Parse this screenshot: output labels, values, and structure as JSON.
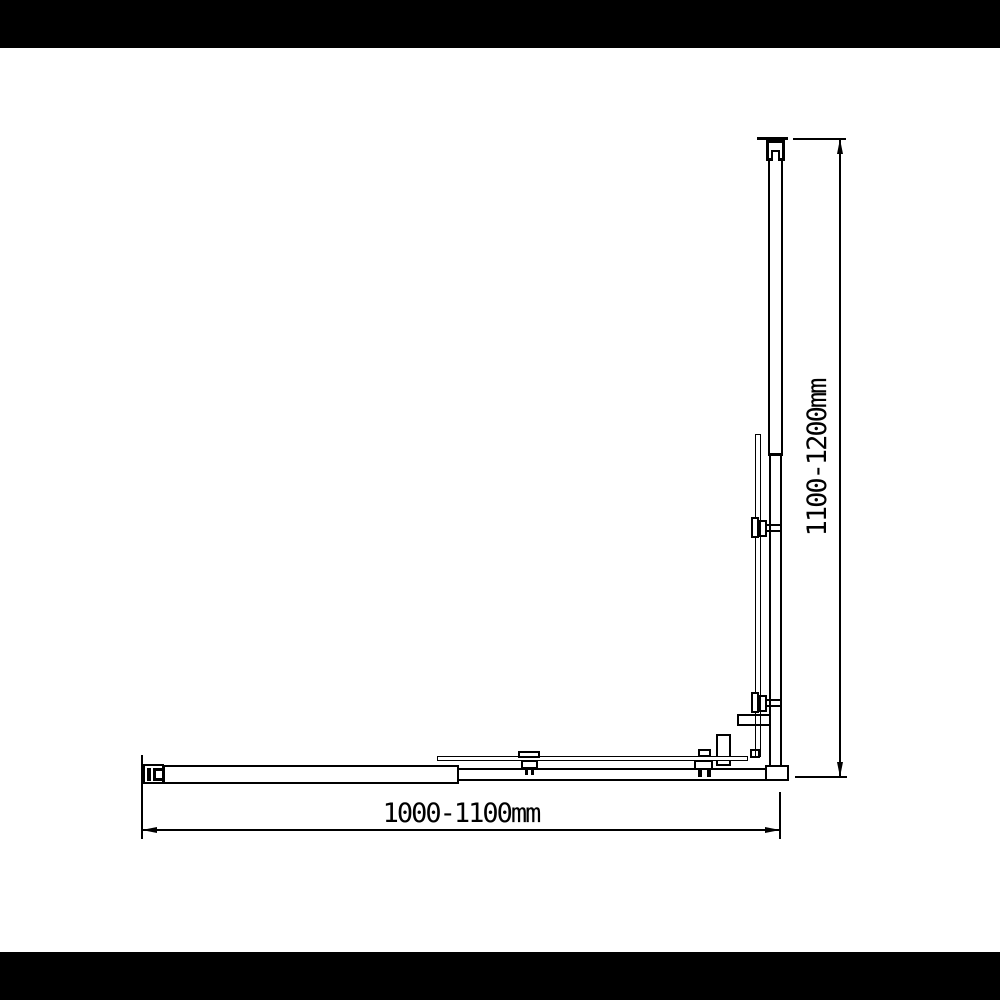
{
  "meta": {
    "description": "Black-and-white technical dimension drawing of an adjustable corner shower screen (wall profiles, glass panels, clamps, bottom rail) with letterboxed black bars top and bottom",
    "background_color": "#ffffff",
    "line_color": "#000000",
    "letterbox_color": "#000000"
  },
  "dimensions": {
    "width_label": "1000-1100mm",
    "height_label": "1100-1200mm"
  }
}
